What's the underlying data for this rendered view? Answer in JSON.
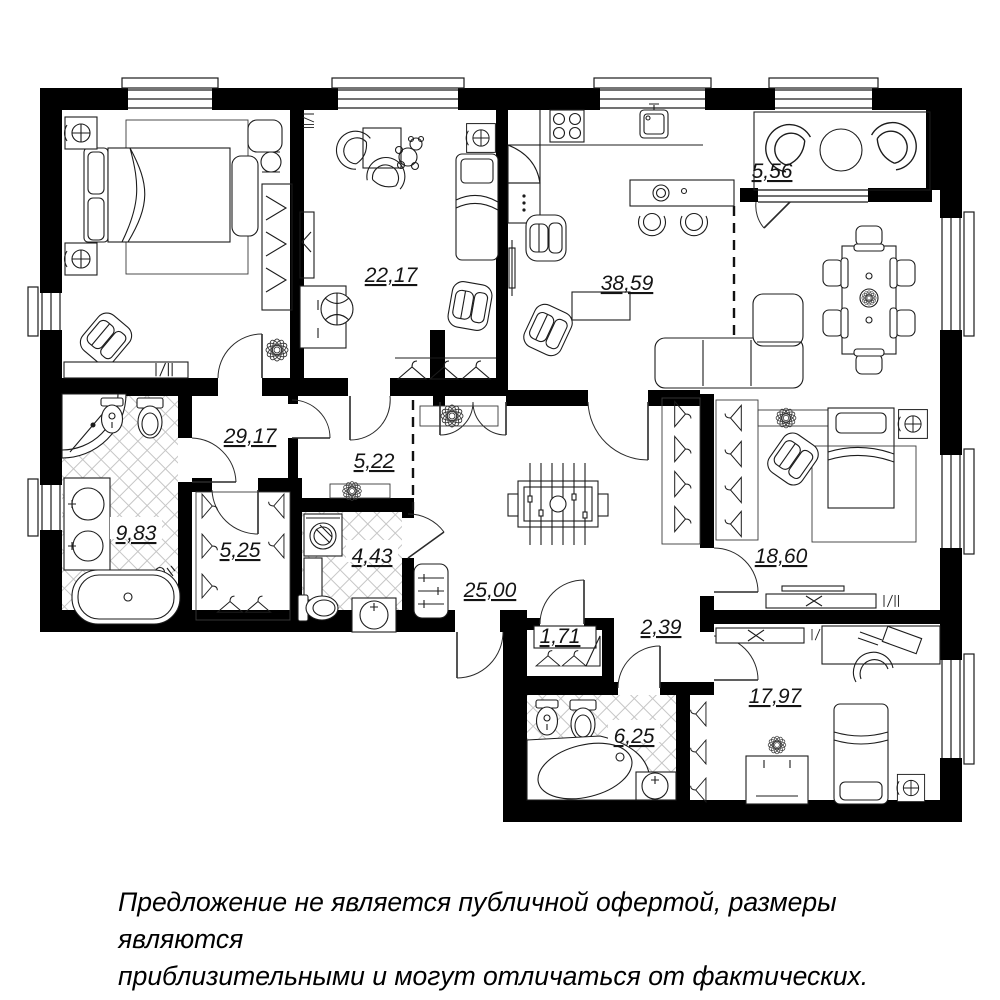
{
  "colors": {
    "wall": "#000000",
    "furniture_line": "#1c1c1c",
    "hatch": "#c6c6c6",
    "background": "#ffffff"
  },
  "rooms": [
    {
      "id": "balcony",
      "label": "5,56"
    },
    {
      "id": "children-room",
      "label": "22,17"
    },
    {
      "id": "kitchen-living-room",
      "label": "38,59"
    },
    {
      "id": "hallway",
      "label": "29,17"
    },
    {
      "id": "inner-hall",
      "label": "5,22"
    },
    {
      "id": "bathroom-master",
      "label": "9,83"
    },
    {
      "id": "wardrobe",
      "label": "5,25"
    },
    {
      "id": "bathroom-guest",
      "label": "4,43"
    },
    {
      "id": "entrance-hall",
      "label": "25,00"
    },
    {
      "id": "closet",
      "label": "1,71"
    },
    {
      "id": "corridor",
      "label": "2,39"
    },
    {
      "id": "bedroom",
      "label": "18,60"
    },
    {
      "id": "bathroom-kids",
      "label": "6,25"
    },
    {
      "id": "bedroom-kids",
      "label": "17,97"
    }
  ],
  "disclaimer": {
    "line1": "Предложение не является публичной офертой, размеры являются",
    "line2": "приблизительными и могут отличаться от фактических."
  }
}
